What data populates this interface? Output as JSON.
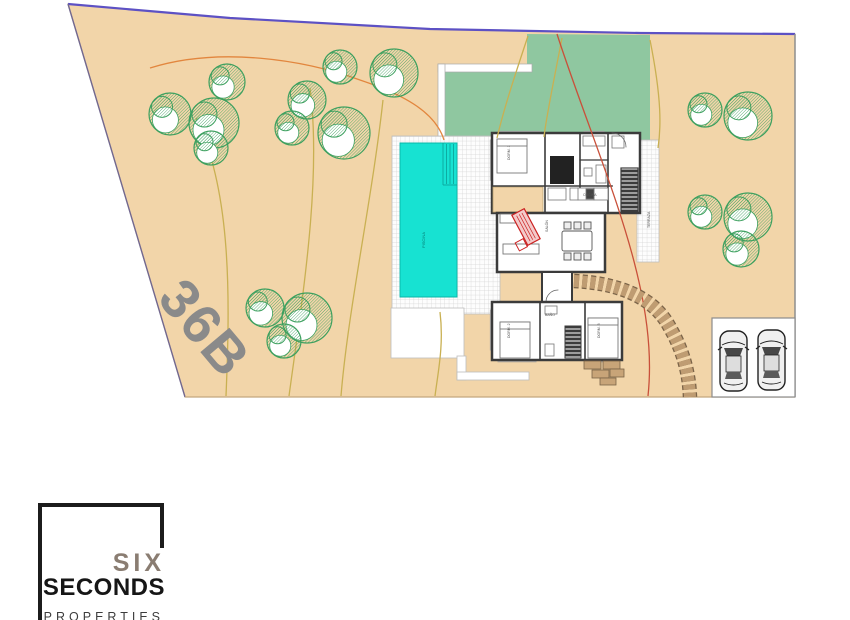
{
  "page": {
    "background": "#ffffff"
  },
  "plot": {
    "label": "36B",
    "fill": "#f2d5a9"
  },
  "boundary": {
    "top_color": "#5d51c4"
  },
  "grass": {
    "fill": "#8fc7a0"
  },
  "pool": {
    "label": "PISCINA",
    "fill": "#17e2d2"
  },
  "rooms": {
    "dorm1": "DORM. 1",
    "salon": "SALÓN",
    "cocina": "COCINA",
    "bano": "BAÑO",
    "dorm2": "DORM. 2",
    "dorm3": "DORM. 3",
    "terraza": "TERRAZA"
  },
  "stamp": {
    "color": "#cc2222"
  },
  "driveway": {
    "stone_color": "#bf9c72"
  },
  "parking": {
    "car_count": "2"
  },
  "logo": {
    "line1": "SIX",
    "line2": "SECONDS",
    "line3": "PROPERTIES"
  },
  "site": {
    "tree_stroke": "#3da05f",
    "trees": [
      {
        "x": 227,
        "y": 82,
        "r": 18
      },
      {
        "x": 170,
        "y": 114,
        "r": 21
      },
      {
        "x": 214,
        "y": 123,
        "r": 25
      },
      {
        "x": 211,
        "y": 148,
        "r": 17
      },
      {
        "x": 340,
        "y": 67,
        "r": 17
      },
      {
        "x": 307,
        "y": 100,
        "r": 19
      },
      {
        "x": 292,
        "y": 128,
        "r": 17
      },
      {
        "x": 344,
        "y": 133,
        "r": 26
      },
      {
        "x": 394,
        "y": 73,
        "r": 24
      },
      {
        "x": 265,
        "y": 308,
        "r": 19
      },
      {
        "x": 307,
        "y": 318,
        "r": 25
      },
      {
        "x": 284,
        "y": 341,
        "r": 17
      },
      {
        "x": 705,
        "y": 110,
        "r": 17
      },
      {
        "x": 748,
        "y": 116,
        "r": 24
      },
      {
        "x": 705,
        "y": 212,
        "r": 17
      },
      {
        "x": 748,
        "y": 217,
        "r": 24
      },
      {
        "x": 741,
        "y": 249,
        "r": 18
      }
    ],
    "contours": [
      {
        "d": "M150,68 C220,46 305,60 360,80 C408,96 436,114 444,140",
        "color": "#e2863e"
      },
      {
        "d": "M196,118 C232,192 230,300 226,396",
        "color": "#c9b052"
      },
      {
        "d": "M310,88 C322,180 302,300 289,396",
        "color": "#c9b052"
      },
      {
        "d": "M383,100 C372,200 348,310 341,396",
        "color": "#c9b052"
      },
      {
        "d": "M440,312 C444,345 438,372 435,396",
        "color": "#c9b052"
      },
      {
        "d": "M528,36 C516,72 504,108 497,138",
        "color": "#c9b052"
      },
      {
        "d": "M562,38 C552,90 546,118 544,137",
        "color": "#c9b052"
      },
      {
        "d": "M557,34 C582,112 622,205 639,282 C650,330 651,368 648,396",
        "color": "#c9503a"
      },
      {
        "d": "M650,40 C662,100 661,128 658,148",
        "color": "#c9b052"
      }
    ]
  }
}
